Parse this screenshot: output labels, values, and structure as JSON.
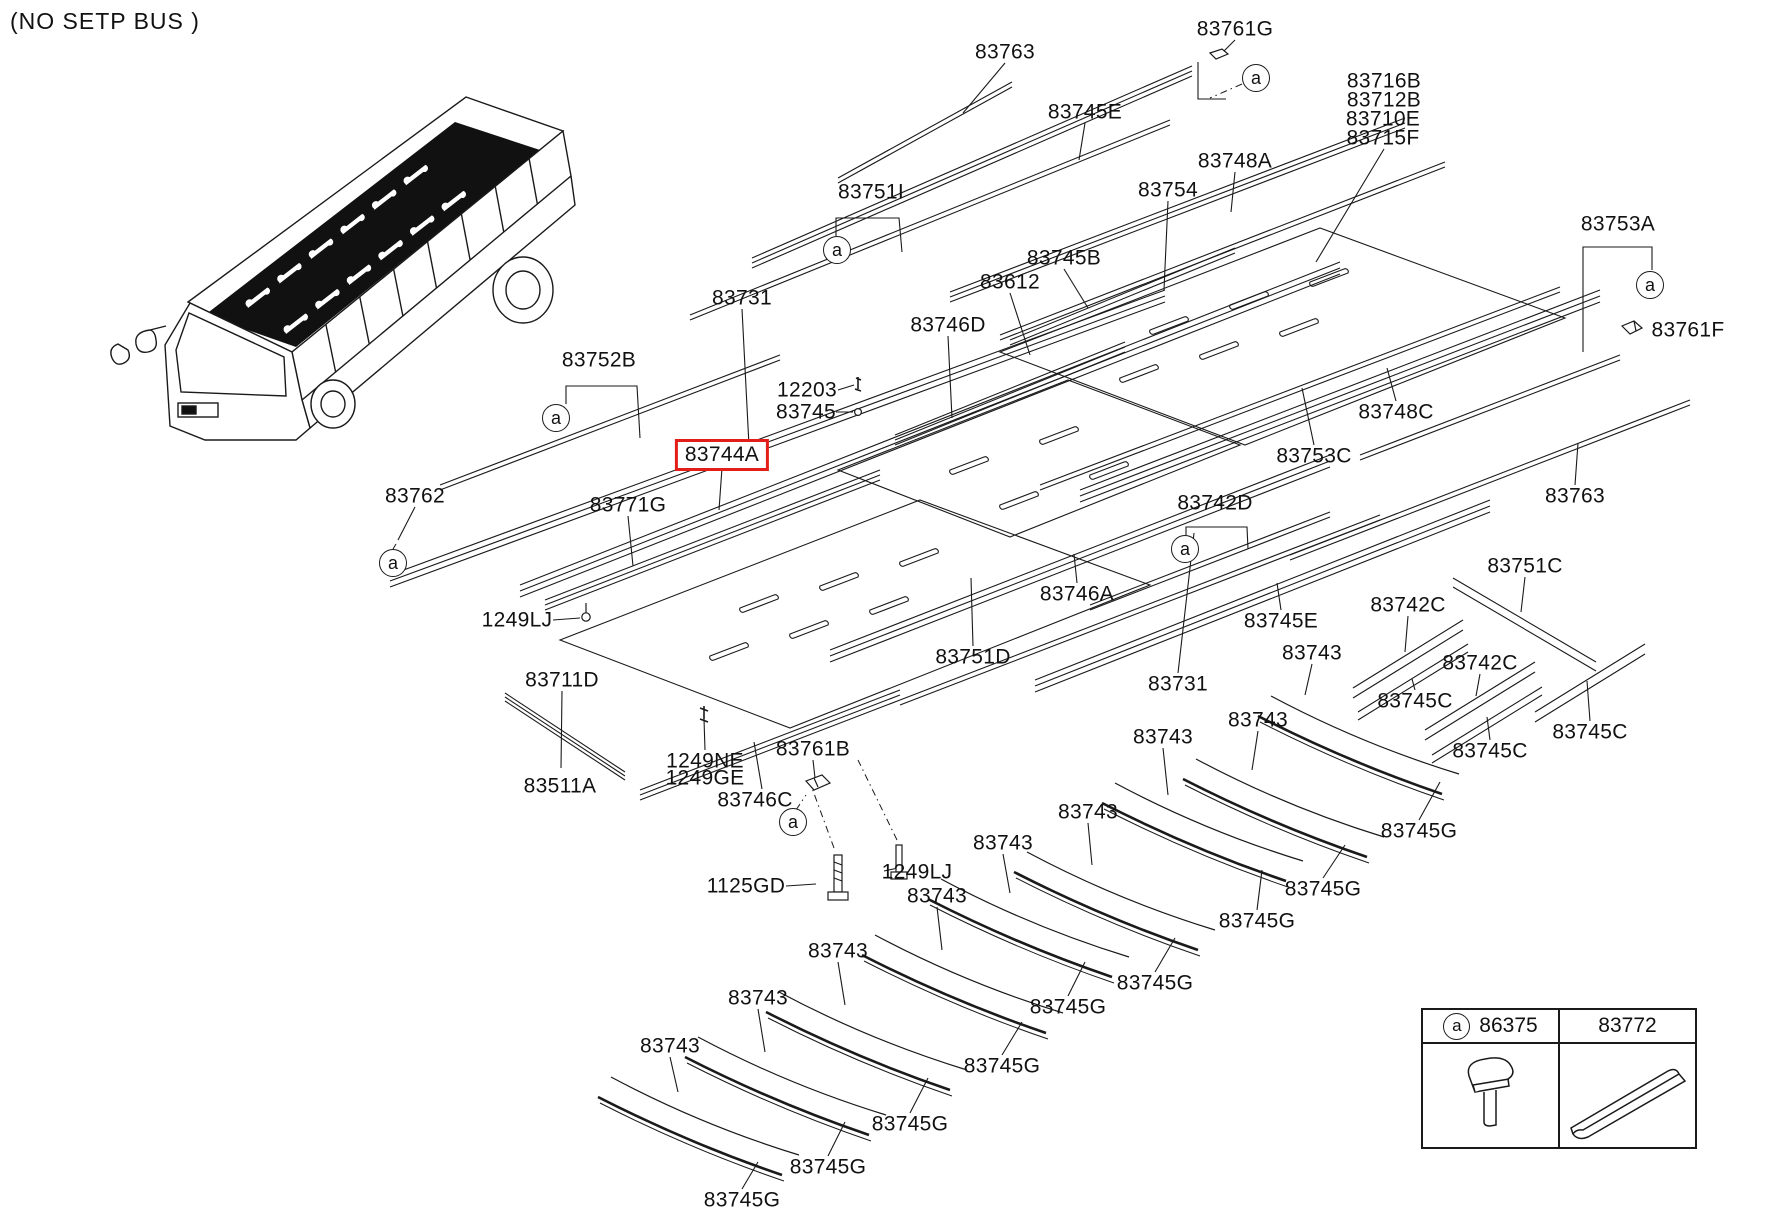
{
  "note": "(NO SETP BUS )",
  "highlight": {
    "part": "83744A",
    "box_color": "#e31d17"
  },
  "line_color": "#1a1a1a",
  "labels": [
    {
      "t": "83761G",
      "x": 1235,
      "y": 29
    },
    {
      "t": "83763",
      "x": 1005,
      "y": 52
    },
    {
      "t": "83745E",
      "x": 1085,
      "y": 112
    },
    {
      "t": "83716B",
      "x": 1384,
      "y": 81
    },
    {
      "t": "83712B",
      "x": 1384,
      "y": 100
    },
    {
      "t": "83710E",
      "x": 1383,
      "y": 119
    },
    {
      "t": "83715F",
      "x": 1383,
      "y": 138
    },
    {
      "t": "83748A",
      "x": 1235,
      "y": 161
    },
    {
      "t": "83751I",
      "x": 871,
      "y": 192
    },
    {
      "t": "83754",
      "x": 1168,
      "y": 190
    },
    {
      "t": "83753A",
      "x": 1618,
      "y": 224
    },
    {
      "t": "83745B",
      "x": 1064,
      "y": 258
    },
    {
      "t": "83612",
      "x": 1010,
      "y": 282
    },
    {
      "t": "83731",
      "x": 742,
      "y": 298
    },
    {
      "t": "83746D",
      "x": 948,
      "y": 325
    },
    {
      "t": "83761F",
      "x": 1688,
      "y": 330
    },
    {
      "t": "83752B",
      "x": 599,
      "y": 360
    },
    {
      "t": "12203",
      "x": 807,
      "y": 390
    },
    {
      "t": "83745",
      "x": 806,
      "y": 412
    },
    {
      "t": "83748C",
      "x": 1396,
      "y": 412
    },
    {
      "t": "83744A",
      "x": 722,
      "y": 455,
      "hl": true
    },
    {
      "t": "83753C",
      "x": 1314,
      "y": 456
    },
    {
      "t": "83762",
      "x": 415,
      "y": 496
    },
    {
      "t": "83763",
      "x": 1575,
      "y": 496
    },
    {
      "t": "83742D",
      "x": 1215,
      "y": 503
    },
    {
      "t": "83771G",
      "x": 628,
      "y": 505
    },
    {
      "t": "83751C",
      "x": 1525,
      "y": 566
    },
    {
      "t": "83746A",
      "x": 1077,
      "y": 594
    },
    {
      "t": "83742C",
      "x": 1408,
      "y": 605
    },
    {
      "t": "1249LJ",
      "x": 517,
      "y": 620
    },
    {
      "t": "83745E",
      "x": 1281,
      "y": 621
    },
    {
      "t": "83743",
      "x": 1312,
      "y": 653
    },
    {
      "t": "83751D",
      "x": 973,
      "y": 657
    },
    {
      "t": "83742C",
      "x": 1480,
      "y": 663
    },
    {
      "t": "83711D",
      "x": 562,
      "y": 680
    },
    {
      "t": "83731",
      "x": 1178,
      "y": 684
    },
    {
      "t": "83745C",
      "x": 1415,
      "y": 701
    },
    {
      "t": "83743",
      "x": 1258,
      "y": 720
    },
    {
      "t": "83743",
      "x": 1163,
      "y": 737
    },
    {
      "t": "83745C",
      "x": 1590,
      "y": 732
    },
    {
      "t": "83761B",
      "x": 813,
      "y": 749
    },
    {
      "t": "83745C",
      "x": 1490,
      "y": 751
    },
    {
      "t": "1249NE",
      "x": 705,
      "y": 761
    },
    {
      "t": "1249GE",
      "x": 705,
      "y": 778
    },
    {
      "t": "83511A",
      "x": 560,
      "y": 786
    },
    {
      "t": "83746C",
      "x": 755,
      "y": 800
    },
    {
      "t": "83743",
      "x": 1088,
      "y": 812
    },
    {
      "t": "83745G",
      "x": 1419,
      "y": 831
    },
    {
      "t": "83743",
      "x": 1003,
      "y": 843
    },
    {
      "t": "1249LJ",
      "x": 917,
      "y": 872
    },
    {
      "t": "1125GD",
      "x": 746,
      "y": 886
    },
    {
      "t": "83745G",
      "x": 1323,
      "y": 889
    },
    {
      "t": "83743",
      "x": 937,
      "y": 896
    },
    {
      "t": "83745G",
      "x": 1257,
      "y": 921
    },
    {
      "t": "83743",
      "x": 838,
      "y": 951
    },
    {
      "t": "83745G",
      "x": 1155,
      "y": 983
    },
    {
      "t": "83743",
      "x": 758,
      "y": 998
    },
    {
      "t": "83745G",
      "x": 1068,
      "y": 1007
    },
    {
      "t": "83743",
      "x": 670,
      "y": 1046
    },
    {
      "t": "83745G",
      "x": 1002,
      "y": 1066
    },
    {
      "t": "83745G",
      "x": 910,
      "y": 1124
    },
    {
      "t": "83745G",
      "x": 828,
      "y": 1167
    },
    {
      "t": "83745G",
      "x": 742,
      "y": 1200
    }
  ],
  "callouts": [
    {
      "s": "a",
      "x": 1256,
      "y": 78
    },
    {
      "s": "a",
      "x": 837,
      "y": 250
    },
    {
      "s": "a",
      "x": 556,
      "y": 418
    },
    {
      "s": "a",
      "x": 393,
      "y": 563
    },
    {
      "s": "a",
      "x": 1185,
      "y": 549
    },
    {
      "s": "a",
      "x": 1650,
      "y": 285
    },
    {
      "s": "a",
      "x": 793,
      "y": 822
    }
  ],
  "legend": {
    "symbol": "a",
    "columns": [
      {
        "part": "86375",
        "icon": "clip-fastener-icon"
      },
      {
        "part": "83772",
        "icon": "moulding-strip-icon"
      }
    ]
  }
}
